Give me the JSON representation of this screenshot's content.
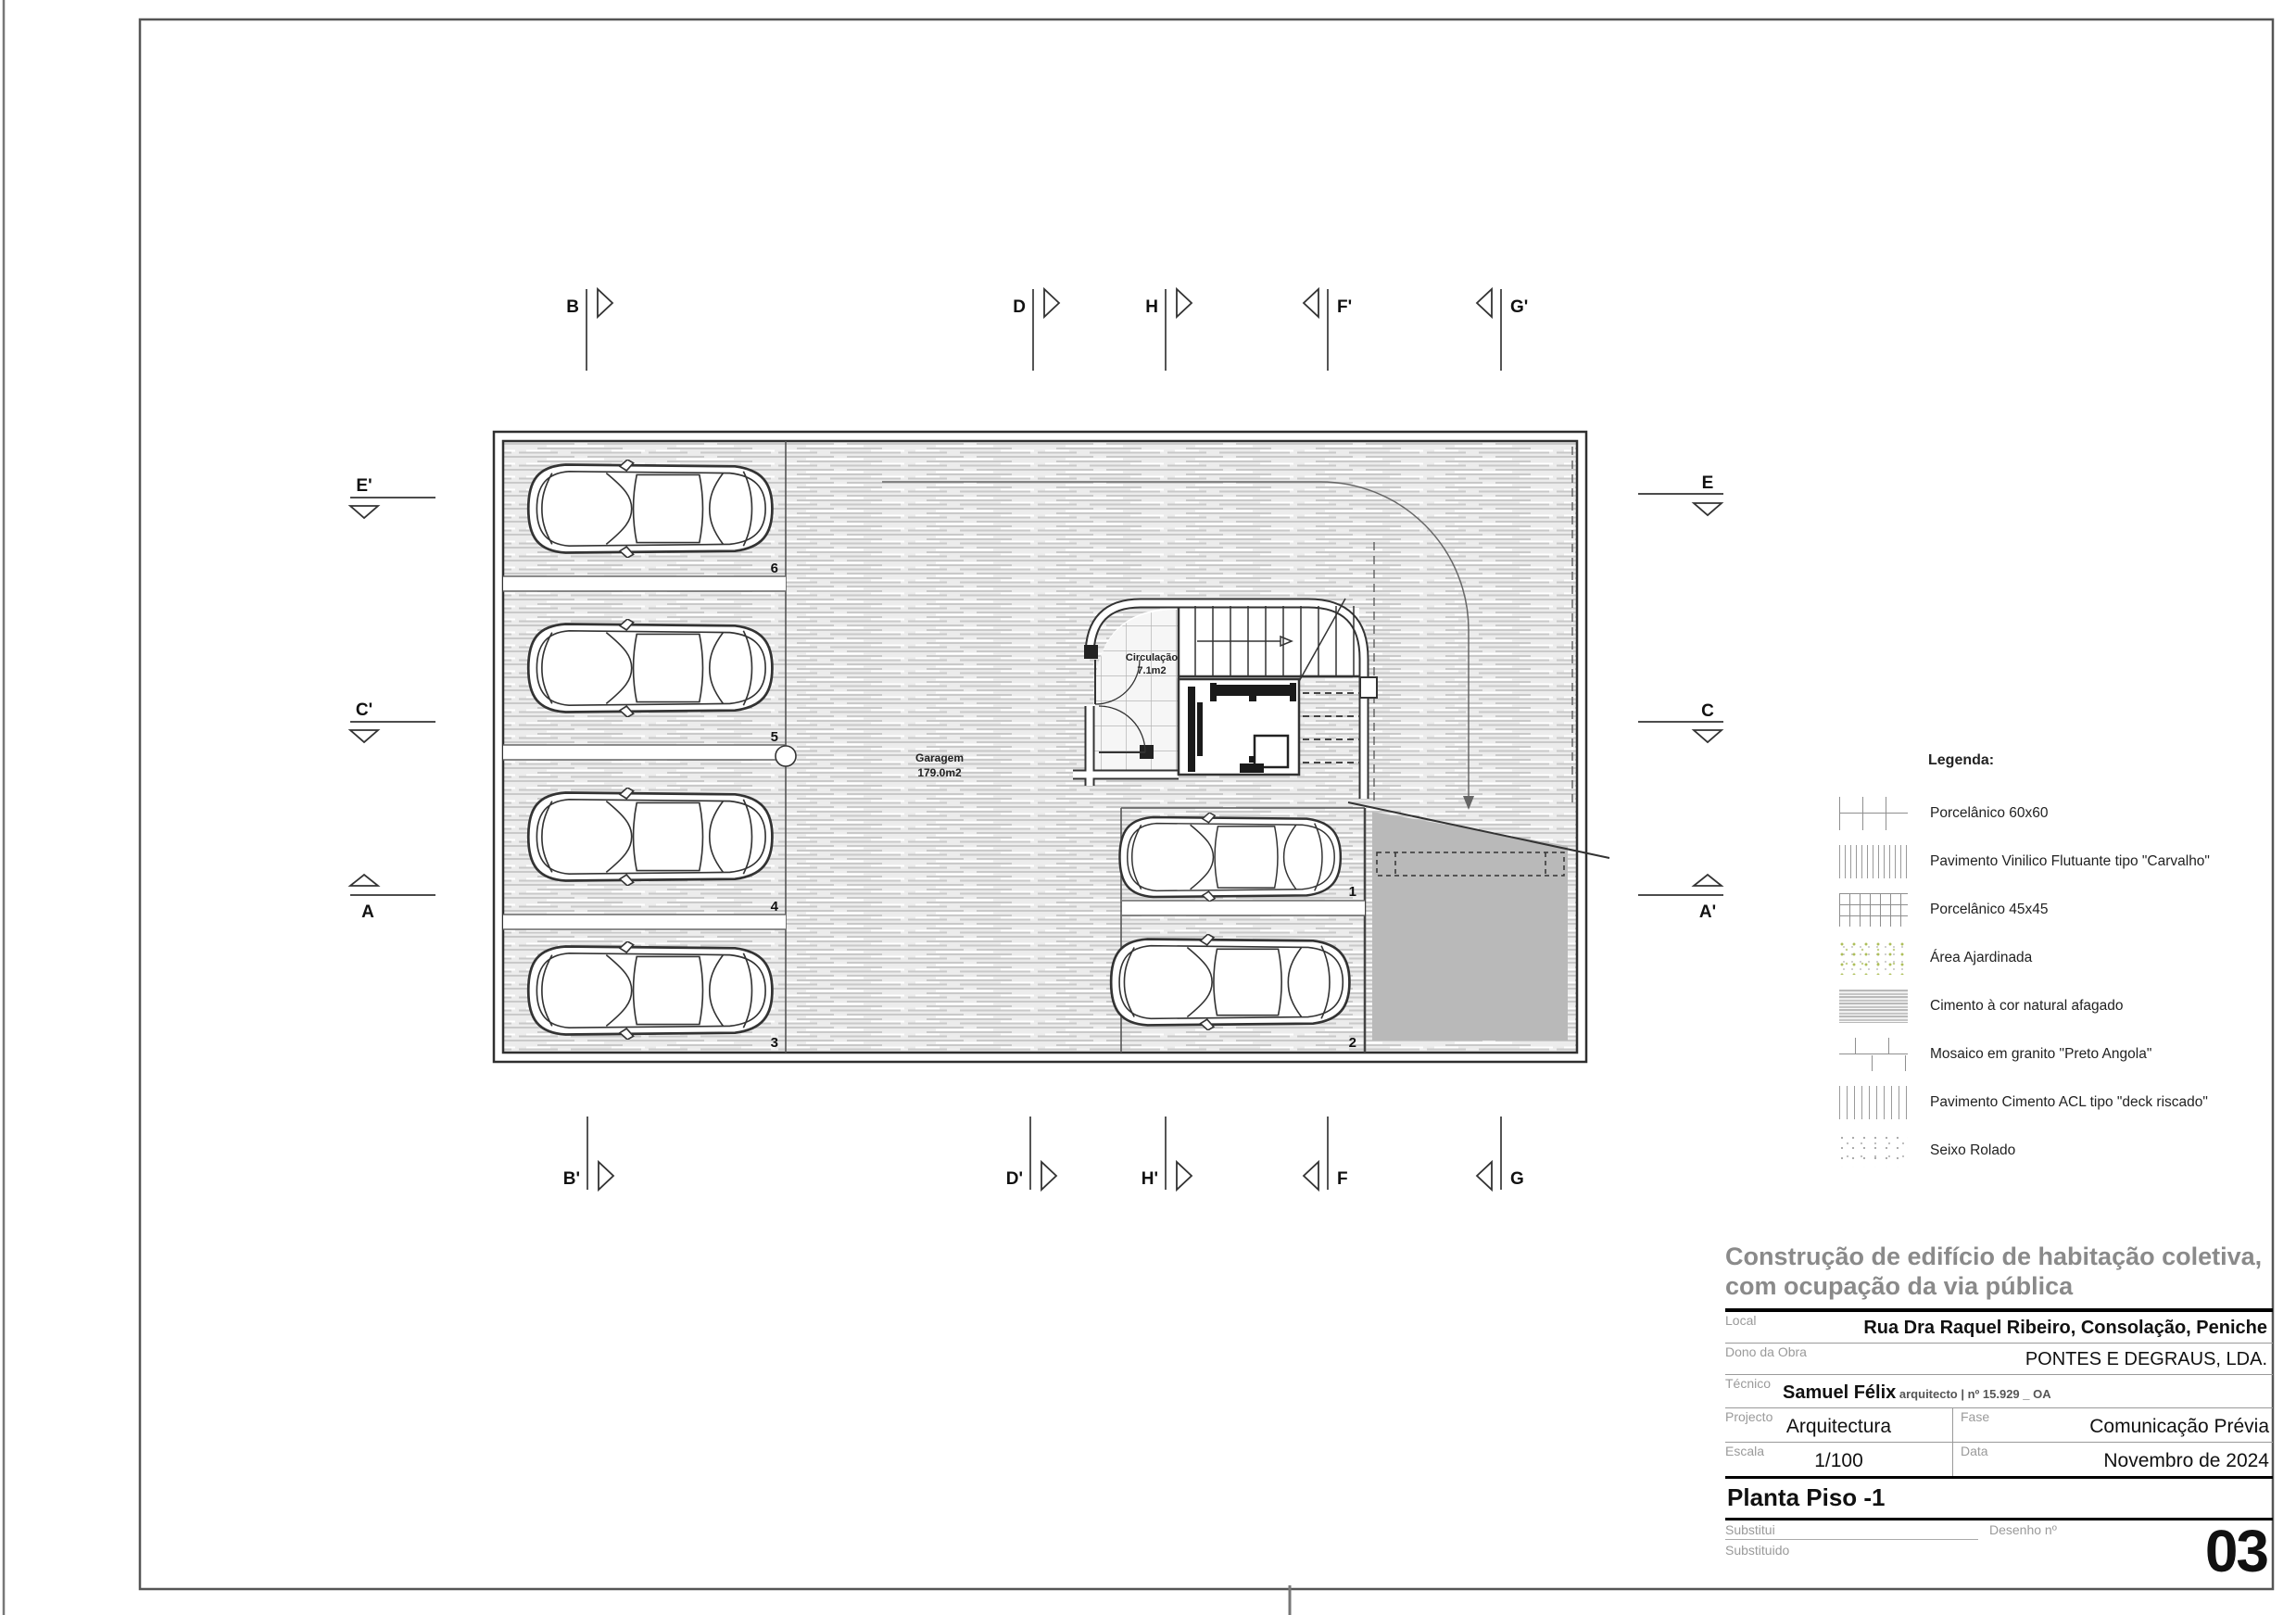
{
  "plan": {
    "garage_label": "Garagem",
    "garage_area": "179.0m2",
    "circulation_label": "Circulação",
    "circulation_area": "7.1m2",
    "stall_numbers": [
      "6",
      "5",
      "4",
      "3",
      "1",
      "2"
    ],
    "section_markers": {
      "top": [
        "B",
        "D",
        "H",
        "F'",
        "G'"
      ],
      "bottom": [
        "B'",
        "D'",
        "H'",
        "F",
        "G"
      ],
      "left": [
        "E'",
        "C'",
        "A"
      ],
      "right": [
        "E",
        "C",
        "A'"
      ]
    }
  },
  "legend": {
    "title": "Legenda:",
    "items": [
      {
        "label": "Porcelânico 60x60",
        "pattern": "grid-large"
      },
      {
        "label": "Pavimento Vinilico Flutuante tipo \"Carvalho\"",
        "pattern": "vertical-dense"
      },
      {
        "label": "Porcelânico 45x45",
        "pattern": "grid-small"
      },
      {
        "label": "Área Ajardinada",
        "pattern": "green-speckle"
      },
      {
        "label": "Cimento à cor natural afagado",
        "pattern": "horizontal-streaks"
      },
      {
        "label": "Mosaico em granito \"Preto Angola\"",
        "pattern": "brick"
      },
      {
        "label": "Pavimento Cimento ACL tipo \"deck riscado\"",
        "pattern": "vertical-sparse"
      },
      {
        "label": "Seixo Rolado",
        "pattern": "gray-speckle"
      }
    ]
  },
  "title_block": {
    "project_title_line1": "Construção de edifício de habitação coletiva,",
    "project_title_line2": "com ocupação da via pública",
    "local_label": "Local",
    "local_value": "Rua Dra Raquel Ribeiro, Consolação, Peniche",
    "owner_label": "Dono da Obra",
    "owner_value": "PONTES E DEGRAUS, LDA.",
    "technician_label": "Técnico",
    "technician_name": "Samuel Félix",
    "technician_credentials": " arquitecto | nº 15.929 _ OA",
    "project_label": "Projecto",
    "project_value": "Arquitectura",
    "phase_label": "Fase",
    "phase_value": "Comunicação Prévia",
    "scale_label": "Escala",
    "scale_value": "1/100",
    "date_label": "Data",
    "date_value": "Novembro de 2024",
    "drawing_title": "Planta Piso -1",
    "replaces_label": "Substitui",
    "replaced_label": "Substituido",
    "drawing_number_label": "Desenho nº",
    "drawing_number": "03"
  },
  "colors": {
    "line_dark": "#333333",
    "wall": "#2f2f2f",
    "floor_streak": "#c9c9c9",
    "ramp_gray": "#b9b9b9",
    "title_gray": "#8a8a8a",
    "garden_green": "#aebf5a"
  }
}
